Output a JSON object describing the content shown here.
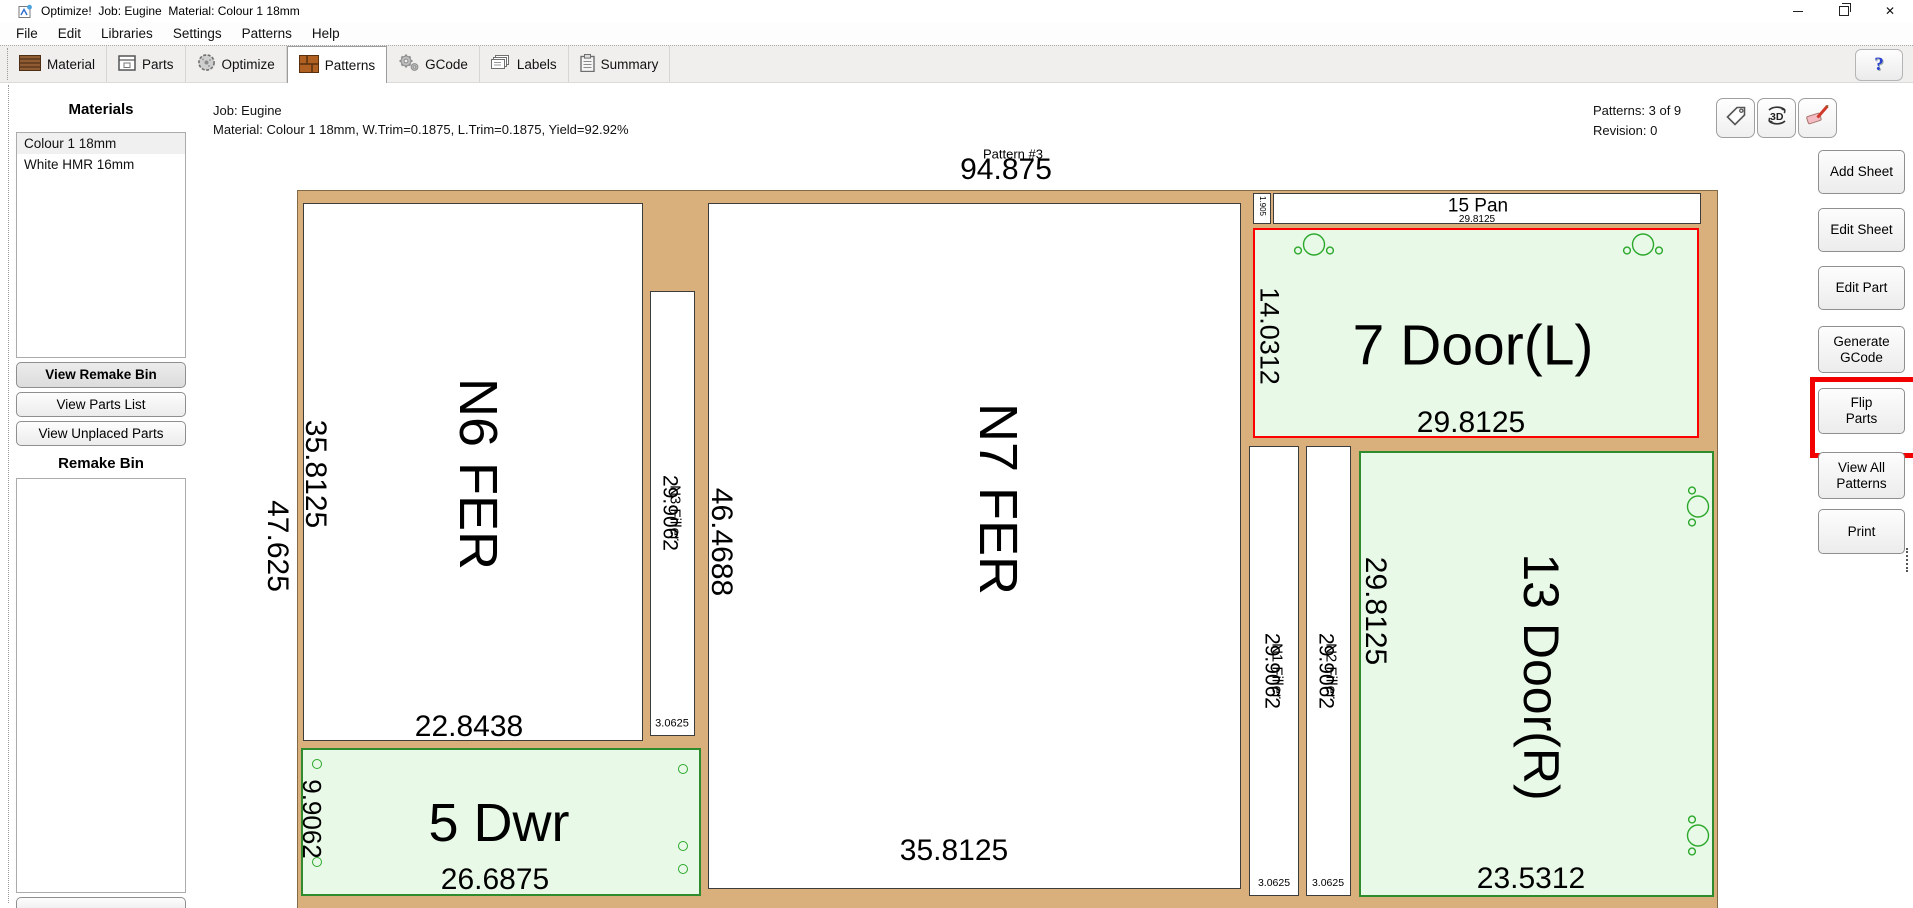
{
  "window": {
    "title": "Optimize!  Job: Eugine  Material: Colour 1 18mm"
  },
  "menu": {
    "items": [
      "File",
      "Edit",
      "Libraries",
      "Settings",
      "Patterns",
      "Help"
    ]
  },
  "tabs": {
    "items": [
      {
        "label": "Material"
      },
      {
        "label": "Parts"
      },
      {
        "label": "Optimize"
      },
      {
        "label": "Patterns"
      },
      {
        "label": "GCode"
      },
      {
        "label": "Labels"
      },
      {
        "label": "Summary"
      }
    ],
    "active": "Patterns",
    "help_label": "?"
  },
  "icons": {
    "rotate_3d": "3D",
    "close_glyph": "✕"
  },
  "sidebar": {
    "materials_heading": "Materials",
    "materials": [
      {
        "label": "Colour 1 18mm"
      },
      {
        "label": "White HMR 16mm"
      }
    ],
    "selected_material": "Colour 1 18mm",
    "view_remake_bin": "View Remake Bin",
    "view_parts_list": "View Parts List",
    "view_unplaced_parts": "View Unplaced Parts",
    "remake_bin_heading": "Remake Bin"
  },
  "header": {
    "job_line": "Job: Eugine",
    "material_line": "Material: Colour 1 18mm, W.Trim=0.1875, L.Trim=0.1875, Yield=92.92%",
    "patterns_count": "Patterns: 3 of 9",
    "revision": "Revision: 0"
  },
  "pattern": {
    "title": "Pattern #3",
    "sheet_length": "94.875",
    "sheet_width": "47.625",
    "parts": {
      "n6": {
        "name": "N6 FER",
        "left_dim": "35.8125",
        "bottom_dim": "22.8438"
      },
      "n3": {
        "name": "N3 Filler",
        "dim": "29.9062",
        "width_dim": "3.0625"
      },
      "n7": {
        "name": "N7 FER",
        "left_dim": "46.4688",
        "bottom_dim": "35.8125"
      },
      "dwr5": {
        "name": "5 Dwr",
        "left_dim": "9.9062",
        "bottom_dim": "26.6875"
      },
      "pan15": {
        "name": "15 Pan",
        "bottom_dim": "29.8125",
        "edge_dim": "1.905"
      },
      "door7": {
        "name": "7 Door(L)",
        "left_dim": "14.0312",
        "bottom_dim": "29.8125",
        "selected": true
      },
      "n1": {
        "name": "N1 Filler",
        "dim": "29.9062",
        "width_dim": "3.0625"
      },
      "n2": {
        "name": "N2 Filler",
        "dim": "29.9062",
        "width_dim": "3.0625"
      },
      "door13": {
        "name": "13 Door(R)",
        "left_dim": "29.8125",
        "bottom_dim": "23.5312"
      }
    }
  },
  "actions": {
    "buttons": [
      {
        "label": "Add Sheet"
      },
      {
        "label": "Edit Sheet"
      },
      {
        "label": "Edit Part"
      },
      {
        "label": "Generate GCode"
      },
      {
        "label": "Flip Parts"
      },
      {
        "label": "View All Patterns"
      },
      {
        "label": "Print"
      }
    ],
    "highlighted": "Flip Parts"
  },
  "colors": {
    "sheet_tan": "#d9b07c",
    "part_green_fill": "#e9f9e8",
    "part_green_border": "#2e8b2e",
    "selection_red": "#ff0000",
    "highlight_red": "#f20000"
  }
}
